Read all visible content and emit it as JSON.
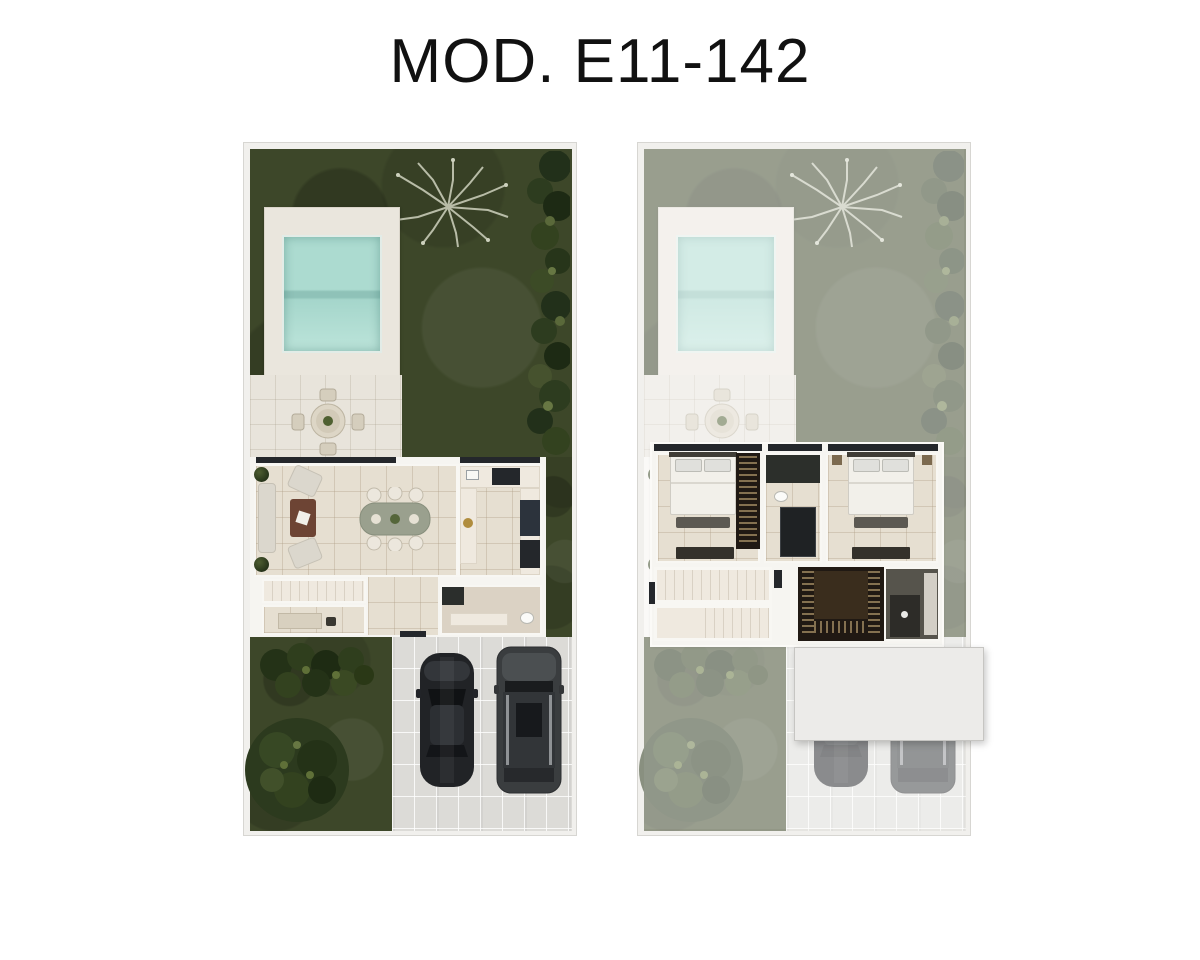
{
  "header": {
    "title": "MOD. E11-142"
  },
  "colors": {
    "page-bg": "#ffffff",
    "title-ink": "#111111",
    "plan-frame": "#f1f0ed",
    "plan-edge": "#d7d6d2",
    "grass": "#3d4729",
    "grass-dark": "#2f3a1f",
    "foliage": "#2a3619",
    "foliage-light": "#4c5b31",
    "pool-water": "#aadacf",
    "pool-water-deep": "#8fc2b8",
    "pool-deck": "#eae6dd",
    "patio": "#e8e4db",
    "tile-floor": "#e6dfd1",
    "tile-line": "#c9bda6",
    "wall": "#f6f5f1",
    "counter": "#efe9df",
    "appliance-dark": "#24272b",
    "fridge": "#2c333c",
    "wood-table": "#6d4434",
    "sofa": "#dbd7cd",
    "dining-top": "#99a08d",
    "chair": "#eee9e0",
    "paver": "#dcdbd7",
    "car-body": "#232528",
    "suv-body": "#3c3f41",
    "roof-slab": "#ecebe9",
    "bed-sheet": "#f2f0ea",
    "pillow": "#e0e0dc",
    "bench": "#5c5952",
    "dresser": "#34312b",
    "closet-bg": "#201913",
    "closet-rail": "#c9a86a",
    "bath-dark": "#56544c",
    "stair-tread": "#d9d1c4",
    "stair-floor": "#efe9df"
  }
}
